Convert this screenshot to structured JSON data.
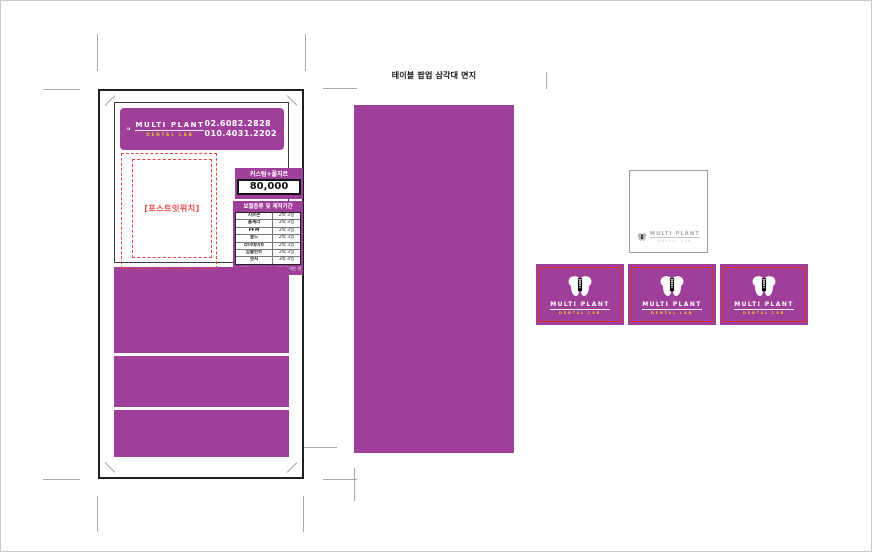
{
  "brand": {
    "name": "MULTI PLANT",
    "sub": "DENTAL LAB"
  },
  "header": {
    "phone1": "02.6082.2828",
    "phone2": "010.4031.2202"
  },
  "postit_label": "[포스트잇위치]",
  "price": {
    "label": "커스텀+풀지르",
    "value": "80,000"
  },
  "schedule": {
    "title": "보철종류 및 제작기간",
    "rows": [
      {
        "type": "지르콘",
        "period": "2박 3일"
      },
      {
        "type": "올세라",
        "period": "2박 3일"
      },
      {
        "type": "PFM",
        "period": "2박 3일"
      },
      {
        "type": "골드",
        "period": "2박 3일"
      },
      {
        "type": "라미네이트",
        "period": "2박 3일"
      },
      {
        "type": "임플란트",
        "period": "2박 3일"
      },
      {
        "type": "덴처",
        "period": "3박 4일"
      }
    ],
    "footnote": "* 기공물+수리 가능 * 자세한 문의는 전화 요망"
  },
  "middle_label": "테이블 팝업 삼각대 면지",
  "colors": {
    "purple": "#a03f9a",
    "yellow": "#f2c433",
    "cutline_red": "#d93025",
    "dashed_red": "#e8483f"
  }
}
